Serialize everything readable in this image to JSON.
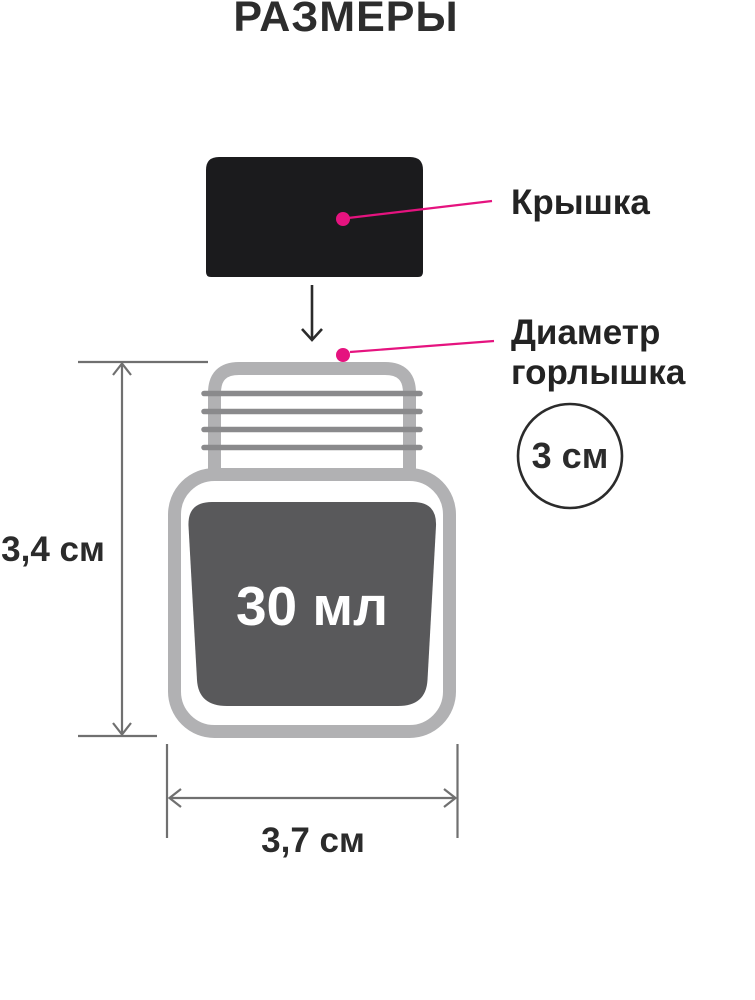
{
  "title": "РАЗМЕРЫ",
  "callouts": {
    "cap": {
      "label": "Крышка"
    },
    "neck": {
      "label": "Диаметр горлышка",
      "value": "3 см"
    }
  },
  "bottle": {
    "volume": "30 мл"
  },
  "dimensions": {
    "height": "3,4 см",
    "width": "3,7 см"
  },
  "colors": {
    "accent_pink": "#e5137f",
    "cap_black": "#1b1b1d",
    "bottle_outline": "#b1b1b3",
    "neck_threads": "#8a8a8c",
    "label_panel": "#59595b",
    "dimension_lines": "#707070",
    "text_dark": "#2b2b2b"
  }
}
